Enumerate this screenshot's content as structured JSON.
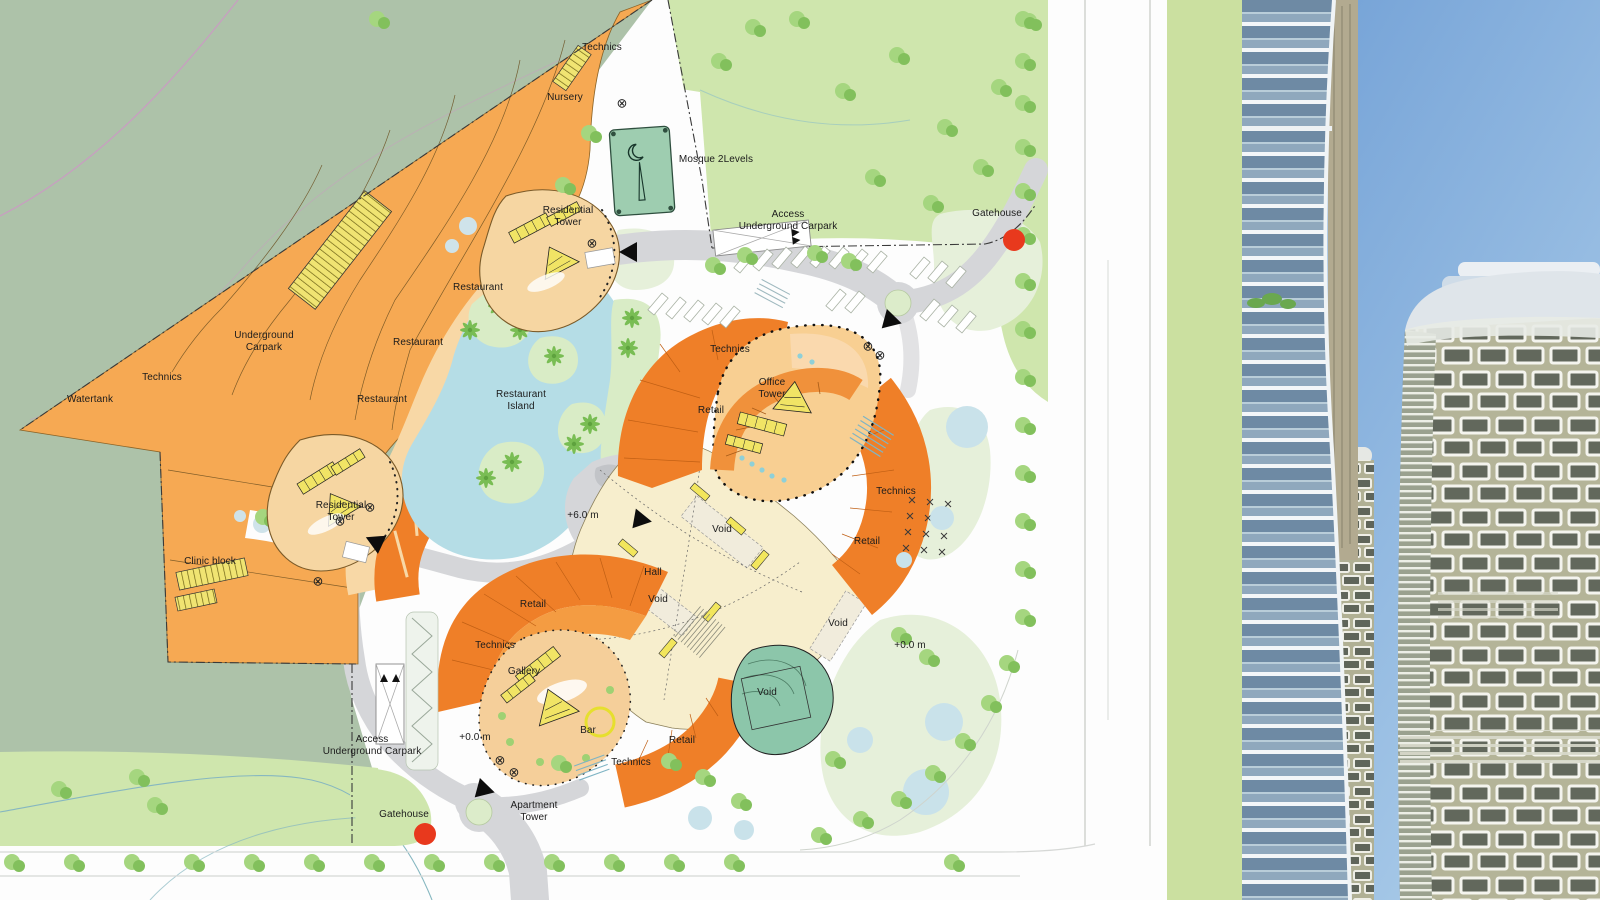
{
  "meta": {
    "page_name": "master-plan-with-tower-rendering",
    "plan_type": "Architectural site plan"
  },
  "map": {
    "labels": [
      {
        "text": "Technics",
        "x": 602,
        "y": 48
      },
      {
        "text": "Nursery",
        "x": 565,
        "y": 98
      },
      {
        "text": "Mosque 2Levels",
        "x": 716,
        "y": 160
      },
      {
        "text": "Residential\nTower",
        "x": 568,
        "y": 217
      },
      {
        "text": "Access\nUnderground Carpark",
        "x": 788,
        "y": 221
      },
      {
        "text": "Gatehouse",
        "x": 997,
        "y": 214
      },
      {
        "text": "Restaurant",
        "x": 478,
        "y": 288
      },
      {
        "text": "Restaurant",
        "x": 418,
        "y": 343
      },
      {
        "text": "Underground\nCarpark",
        "x": 264,
        "y": 342
      },
      {
        "text": "Restaurant",
        "x": 382,
        "y": 400
      },
      {
        "text": "Technics",
        "x": 162,
        "y": 378
      },
      {
        "text": "Watertank",
        "x": 90,
        "y": 400
      },
      {
        "text": "Restaurant\nIsland",
        "x": 521,
        "y": 401
      },
      {
        "text": "Technics",
        "x": 730,
        "y": 350
      },
      {
        "text": "Office\nTower",
        "x": 772,
        "y": 389
      },
      {
        "text": "Retail",
        "x": 711,
        "y": 411
      },
      {
        "text": "Technics",
        "x": 896,
        "y": 492
      },
      {
        "text": "Retail",
        "x": 867,
        "y": 542
      },
      {
        "text": "+6.0 m",
        "x": 583,
        "y": 516
      },
      {
        "text": "Void",
        "x": 722,
        "y": 530
      },
      {
        "text": "Hall",
        "x": 653,
        "y": 573
      },
      {
        "text": "Void",
        "x": 658,
        "y": 600
      },
      {
        "text": "Residential\nTower",
        "x": 341,
        "y": 512
      },
      {
        "text": "Clinic block",
        "x": 210,
        "y": 562
      },
      {
        "text": "Retail",
        "x": 533,
        "y": 605
      },
      {
        "text": "Void",
        "x": 838,
        "y": 624
      },
      {
        "text": "Technics",
        "x": 495,
        "y": 646
      },
      {
        "text": "Gallery",
        "x": 524,
        "y": 672
      },
      {
        "text": "+0.0 m",
        "x": 910,
        "y": 646
      },
      {
        "text": "Void",
        "x": 767,
        "y": 693
      },
      {
        "text": "Bar",
        "x": 588,
        "y": 731
      },
      {
        "text": "Retail",
        "x": 682,
        "y": 741
      },
      {
        "text": "Technics",
        "x": 631,
        "y": 763
      },
      {
        "text": "+0.0 m",
        "x": 475,
        "y": 738
      },
      {
        "text": "Access\nUnderground Carpark",
        "x": 372,
        "y": 746
      },
      {
        "text": "Apartment\nTower",
        "x": 534,
        "y": 812
      },
      {
        "text": "Gatehouse",
        "x": 404,
        "y": 815
      }
    ],
    "markers": {
      "red_dots": [
        {
          "name": "gatehouse-marker-north",
          "x": 1014,
          "y": 240
        },
        {
          "name": "gatehouse-marker-south",
          "x": 425,
          "y": 834
        }
      ],
      "arrows": [
        {
          "x": 628,
          "y": 252,
          "deg": 180
        },
        {
          "x": 893,
          "y": 321,
          "deg": 15
        },
        {
          "x": 643,
          "y": 520,
          "deg": 10
        },
        {
          "x": 374,
          "y": 541,
          "deg": 205
        },
        {
          "x": 486,
          "y": 790,
          "deg": 15
        }
      ],
      "circle_crosses": [
        {
          "x": 622,
          "y": 103
        },
        {
          "x": 592,
          "y": 243
        },
        {
          "x": 370,
          "y": 507
        },
        {
          "x": 340,
          "y": 521
        },
        {
          "x": 318,
          "y": 581
        },
        {
          "x": 868,
          "y": 346
        },
        {
          "x": 880,
          "y": 355
        },
        {
          "x": 500,
          "y": 760
        },
        {
          "x": 514,
          "y": 772
        }
      ]
    },
    "palette": {
      "terrain_sage": "#adc2a9",
      "lawn": "#cfe6ad",
      "lawn_pale": "#e6f0da",
      "carpark_orange": "#f6a953",
      "retail_orange": "#ef7f28",
      "pad_tan": "#f6d6a2",
      "mall_cream": "#f7eecd",
      "lagoon_blue": "#b5dde6",
      "road_gray": "#d5d6d9",
      "building_yellow": "#f1e465",
      "mosque_teal": "#9ecdb0",
      "marker_red": "#e8391d"
    }
  },
  "photo": {
    "description": "Rendering of curved high-rise towers against blue sky",
    "sky_top": "#6f9ed5",
    "sky_bottom": "#abcce9",
    "glass_balconies": "#8fa8bd",
    "facade_khaki": "#b4b498",
    "frame_white": "#f2f2ea"
  }
}
